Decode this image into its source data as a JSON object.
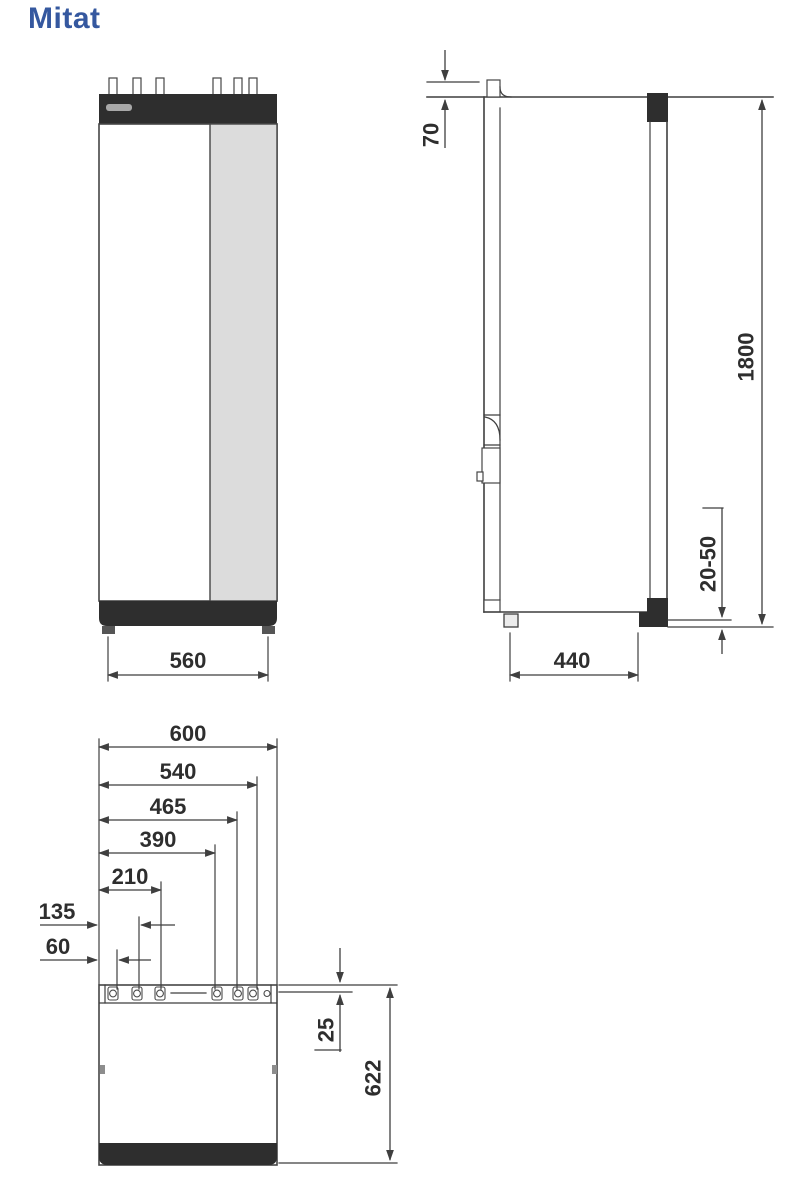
{
  "title": "Mitat",
  "colors": {
    "title_blue": "#35589f",
    "line": "#3f3f3f",
    "panel_dark": "#2e2e2e",
    "panel_gray": "#dcdcdc"
  },
  "front_view": {
    "width": "560"
  },
  "side_view": {
    "pipe_top_offset": "70",
    "height": "1800",
    "foot_adjust_range": "20-50",
    "foot_spacing": "440"
  },
  "top_view": {
    "connection_offsets": [
      "600",
      "540",
      "465",
      "390",
      "210",
      "135",
      "60"
    ],
    "rear_clearance": "25",
    "depth": "622"
  }
}
